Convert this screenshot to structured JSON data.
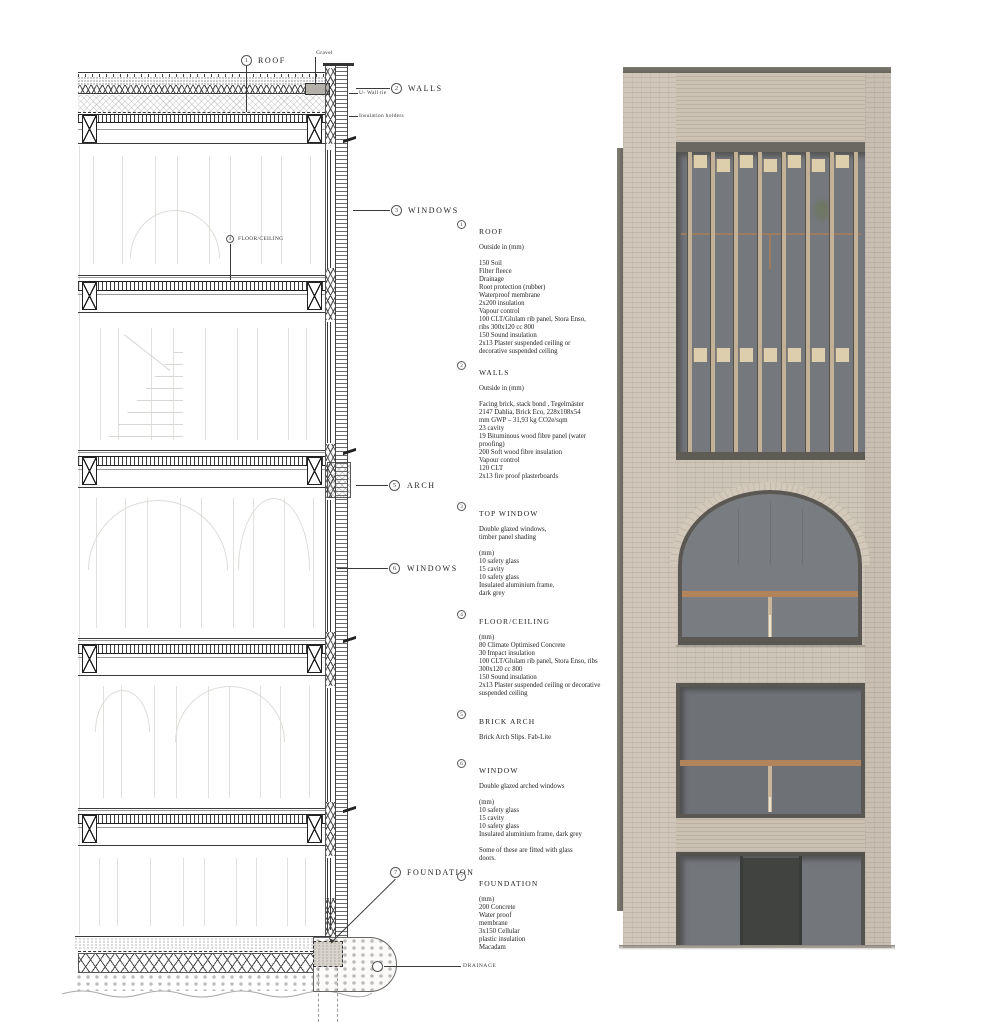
{
  "sheet": {
    "kind": "building section detail with facade render"
  },
  "callouts": {
    "roof": {
      "num": "1",
      "label": "ROOF"
    },
    "walls": {
      "num": "2",
      "label": "WALLS"
    },
    "windows_top": {
      "num": "3",
      "label": "WINDOWS"
    },
    "floor_ceiling": {
      "num": "4",
      "label": "FLOOR/CEILING"
    },
    "arch": {
      "num": "5",
      "label": "ARCH"
    },
    "windows_mid": {
      "num": "6",
      "label": "WINDOWS"
    },
    "foundation": {
      "num": "7",
      "label": "FOUNDATION"
    },
    "gravel": "Gravel",
    "wall_tie": "U- Wall tie",
    "insulation_holders": "Insulation holders",
    "drainage": "DRAINAGE"
  },
  "specs": {
    "sections": [
      {
        "num": "1",
        "title": "ROOF",
        "lines": [
          "Outside in (mm)",
          "",
          "150 Soil",
          "Filter fleece",
          "Drainage",
          "Root protection (rubber)",
          "Waterproof membrane",
          "2x200 insulation",
          "Vapour control",
          "100 CLT/Glulam rib panel, Stora Enso,",
          "ribs 300x120 cc 800",
          "150 Sound insulation",
          "2x13 Plaster suspended ceiling or",
          "decorative suspended ceiling"
        ]
      },
      {
        "num": "2",
        "title": "WALLS",
        "lines": [
          "Outside in (mm)",
          "",
          "Facing brick, stack bond , Tegelmäster",
          "2147 Dahlia, Brick Eco, 228x108x54",
          "mm GWP – 31,93 kg CO2e/sqm",
          "23 cavity",
          "19 Bituminous wood fibre panel (water",
          "proofing)",
          "200 Soft wood fibre insulation",
          "Vapour control",
          "120 CLT",
          "2x13 fire proof plasterboards"
        ]
      },
      {
        "num": "3",
        "title": "TOP WINDOW",
        "lines": [
          "Double glazed windows,",
          "timber panel shading",
          "",
          "(mm)",
          "10 safety glass",
          "15 cavity",
          "10  safety glass",
          "Insulated aluminium frame,",
          "dark grey"
        ]
      },
      {
        "num": "4",
        "title": "FLOOR/CEILING",
        "lines": [
          "(mm)",
          "80 Climate Optimised Concrete",
          "30 Impact insulation",
          "100 CLT/Glulam rib panel, Stora Enso, ribs",
          "300x120 cc 800",
          "150 Sound insulation",
          "2x13 Plaster suspended ceiling or decorative",
          "suspended ceiling"
        ]
      },
      {
        "num": "5",
        "title": "BRICK ARCH",
        "lines": [
          "Brick Arch Slips. Fab-Lite"
        ]
      },
      {
        "num": "6",
        "title": "WINDOW",
        "lines": [
          "Double glazed arched windows",
          "",
          "(mm)",
          "10 safety glass",
          "15 cavity",
          "10 safety glass",
          "Insulated aluminium frame, dark grey",
          "",
          "Some of these are fitted with glass",
          "doors."
        ]
      },
      {
        "num": "7",
        "title": "FOUNDATION",
        "lines": [
          "(mm)",
          "200 Concrete",
          "Water proof",
          "membrane",
          "3x150 Cellular",
          "plastic insulation",
          "Macadam"
        ]
      }
    ]
  },
  "colors": {
    "brick_field": "#cdc5b8",
    "brick_pier": "#d0c7ba",
    "brick_band": "#cbc1b2",
    "coping": "#6e6b64",
    "glazing_upper": "#75787d",
    "glazing_lower": "#6e7176",
    "timber_fin": "#c2b097",
    "timber_panel": "#ddcfac",
    "timber_transom": "#b2845c",
    "door": "#414340",
    "frame_dark": "#5b5853"
  }
}
